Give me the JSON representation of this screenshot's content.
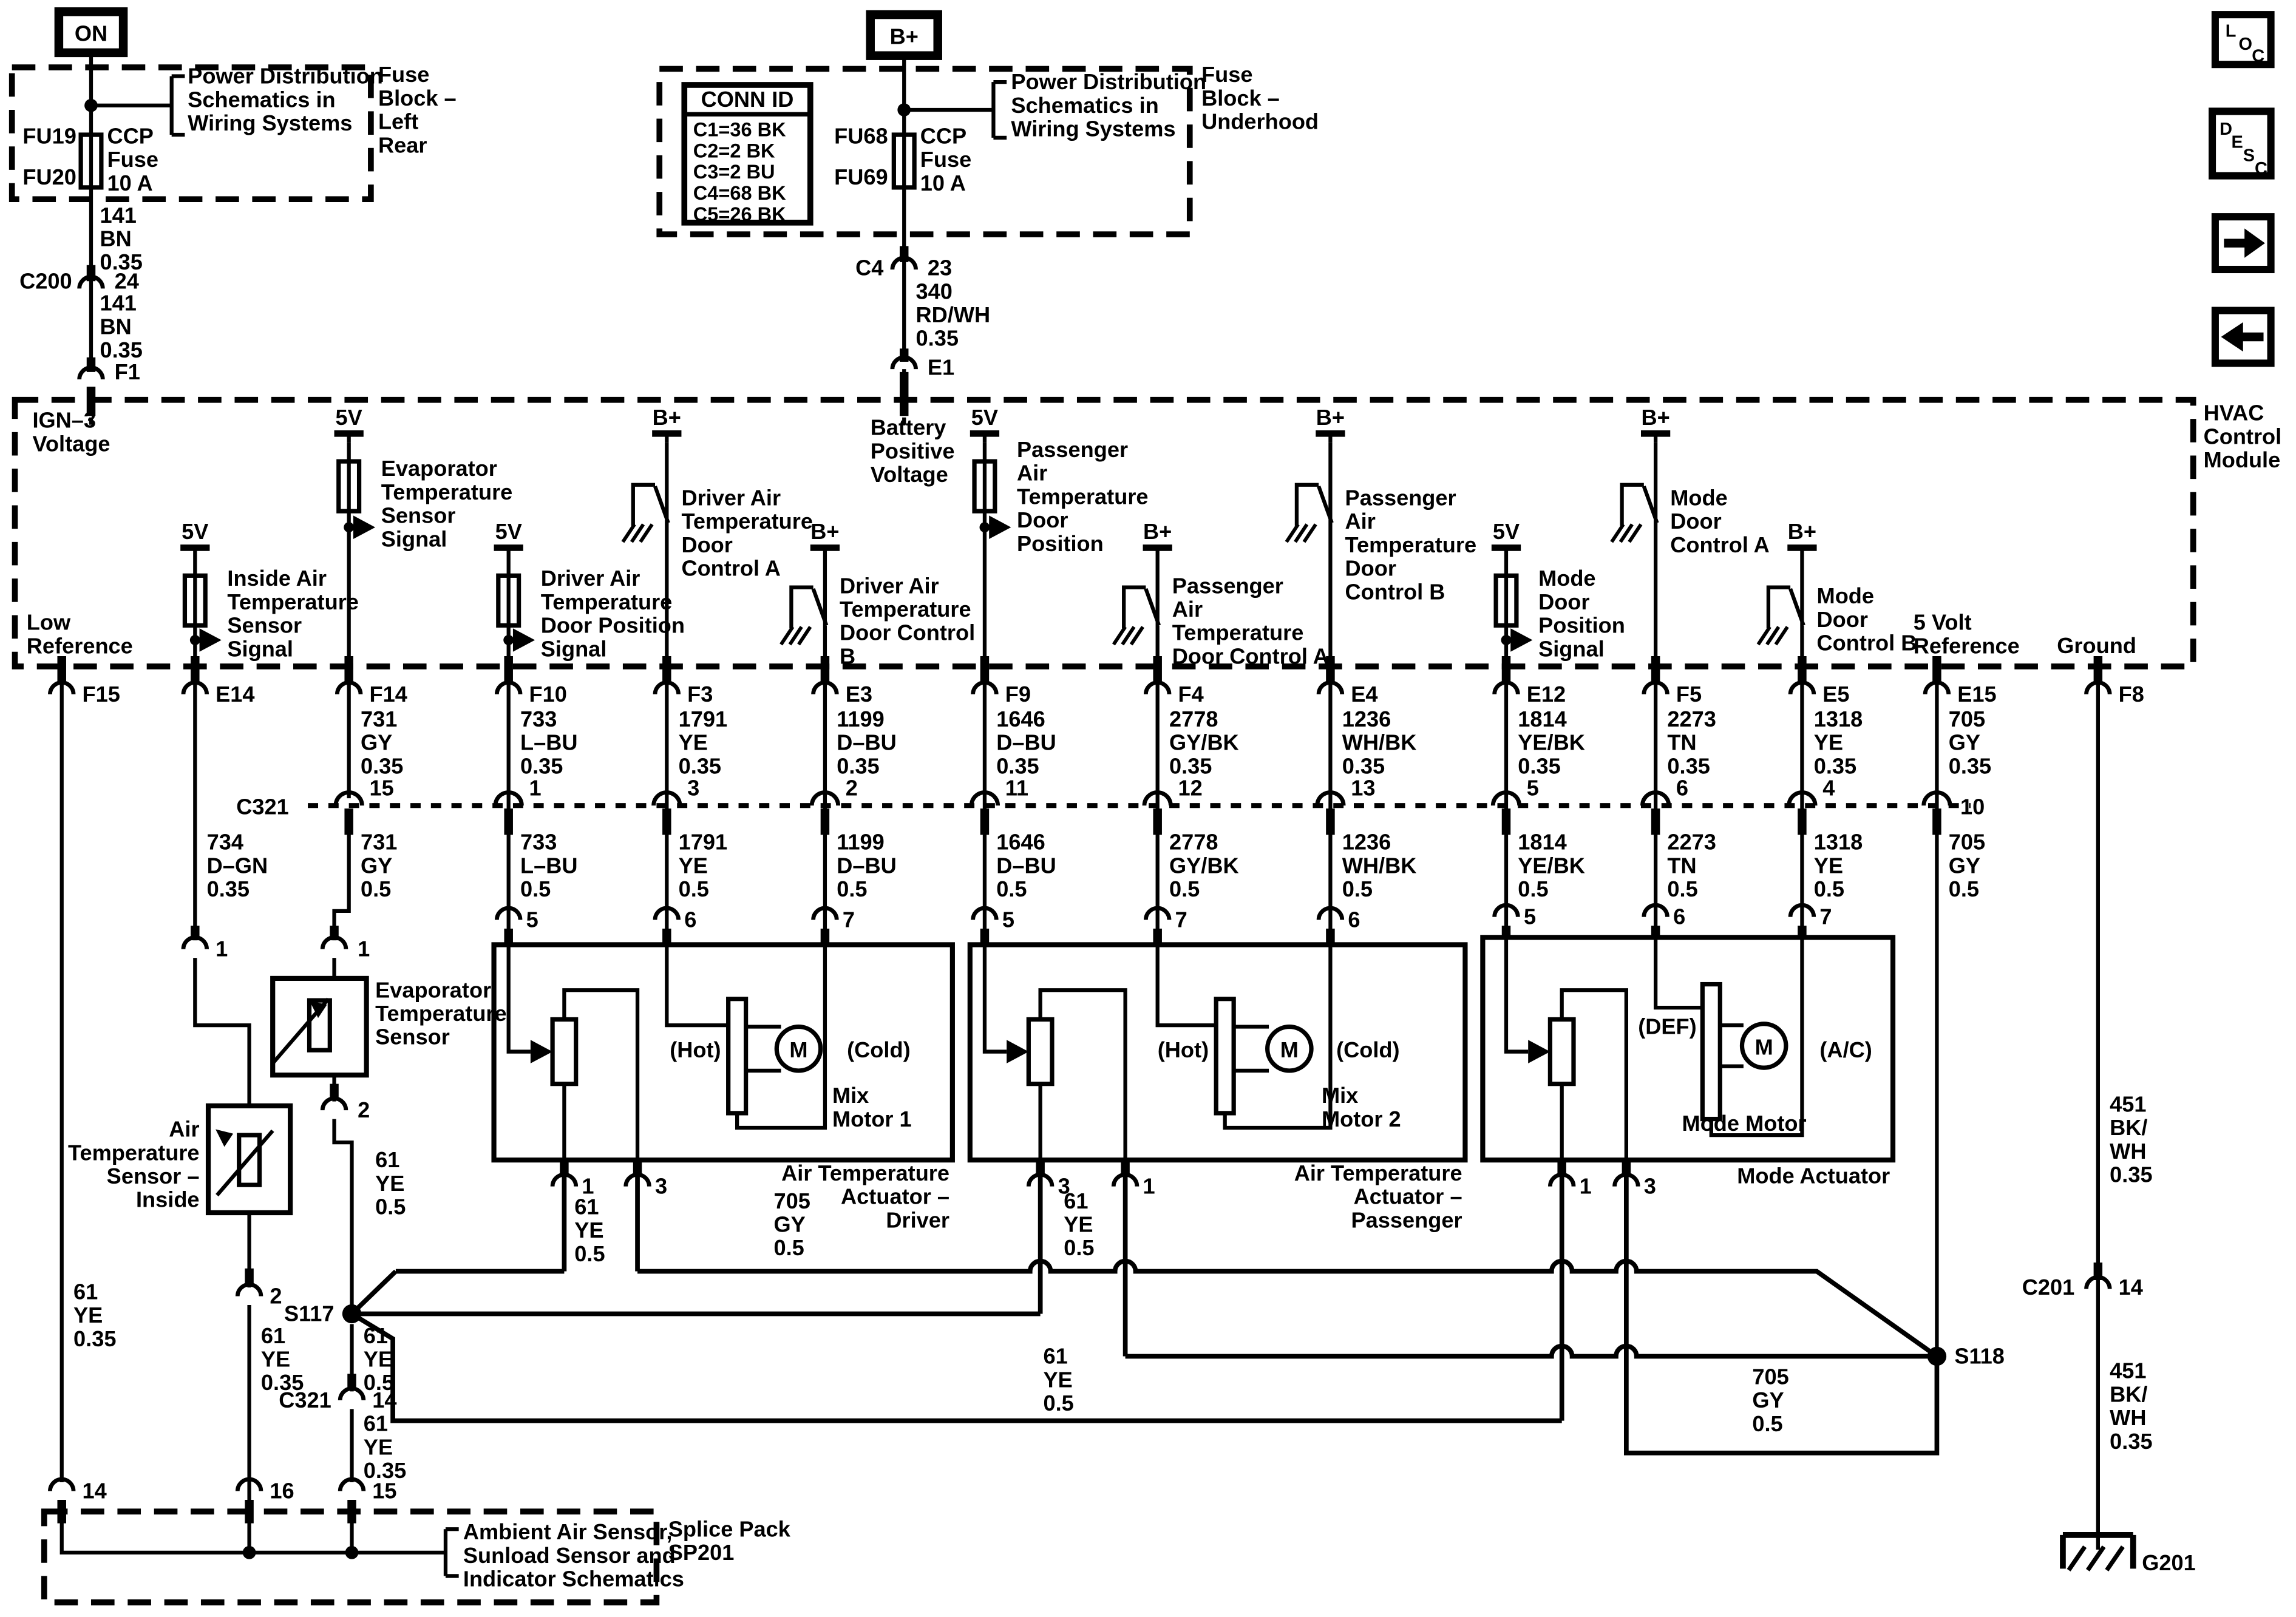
{
  "tl": {
    "on": "ON",
    "pd": [
      "Power Distribution",
      "Schematics in",
      "Wiring Systems"
    ],
    "block": [
      "Fuse",
      "Block –",
      "Left",
      "Rear"
    ],
    "fu_top": "FU19",
    "fu_bot": "FU20",
    "fuse": [
      "CCP",
      "Fuse",
      "10 A"
    ],
    "w1": [
      "141",
      "BN",
      "0.35"
    ],
    "c200": "C200",
    "p24": "24",
    "w2": [
      "141",
      "BN",
      "0.35"
    ],
    "f1": "F1"
  },
  "tm2": {
    "bp": "B+",
    "cid": "CONN ID",
    "rows": [
      "C1=36 BK",
      "C2=2 BK",
      "C3=2 BU",
      "C4=68 BK",
      "C5=26 BK"
    ],
    "fu_top": "FU68",
    "fu_bot": "FU69",
    "fuse": [
      "CCP",
      "Fuse",
      "10 A"
    ],
    "pd": [
      "Power Distribution",
      "Schematics in",
      "Wiring Systems"
    ],
    "block": [
      "Fuse",
      "Block –",
      "Underhood"
    ],
    "c4": "C4",
    "p23": "23",
    "w": [
      "340",
      "RD/WH",
      "0.35"
    ],
    "e1": "E1"
  },
  "nav": {
    "l1": "L",
    "l2": "O",
    "l3": "C",
    "d1": "D",
    "d2": "E",
    "d3": "S",
    "d4": "C"
  },
  "mod": {
    "name": [
      "HVAC",
      "Control",
      "Module"
    ],
    "ign": [
      "IGN–3",
      "Voltage"
    ],
    "low": [
      "Low",
      "Reference"
    ],
    "batt": [
      "Battery",
      "Positive",
      "Voltage"
    ],
    "v5": "5V",
    "bp": "B+",
    "inside": [
      "Inside Air",
      "Temperature",
      "Sensor",
      "Signal"
    ],
    "evap": [
      "Evaporator",
      "Temperature",
      "Sensor",
      "Signal"
    ],
    "dpos": [
      "Driver Air",
      "Temperature",
      "Door Position",
      "Signal"
    ],
    "dca": [
      "Driver Air",
      "Temperature",
      "Door",
      "Control A"
    ],
    "dcb": [
      "Driver Air",
      "Temperature",
      "Door Control",
      "B"
    ],
    "ppos": [
      "Passenger",
      "Air",
      "Temperature",
      "Door",
      "Position"
    ],
    "pca": [
      "Passenger",
      "Air",
      "Temperature",
      "Door Control A"
    ],
    "pcb": [
      "Passenger",
      "Air",
      "Temperature",
      "Door",
      "Control B"
    ],
    "mpos": [
      "Mode",
      "Door",
      "Position",
      "Signal"
    ],
    "mca": [
      "Mode",
      "Door",
      "Control A"
    ],
    "mcb": [
      "Mode",
      "Door",
      "Control B"
    ],
    "vref": [
      "5 Volt",
      "Reference"
    ],
    "gnd": "Ground"
  },
  "pins": {
    "f15": "F15",
    "e14": "E14",
    "f14": "F14",
    "f10": "F10",
    "f3": "F3",
    "e3": "E3",
    "f9": "F9",
    "f4": "F4",
    "e4": "E4",
    "e12": "E12",
    "f5": "F5",
    "e5": "E5",
    "e15": "E15",
    "f8": "F8"
  },
  "wa": {
    "f14": [
      "731",
      "GY",
      "0.35"
    ],
    "f10": [
      "733",
      "L–BU",
      "0.35"
    ],
    "f3": [
      "1791",
      "YE",
      "0.35"
    ],
    "e3": [
      "1199",
      "D–BU",
      "0.35"
    ],
    "f9": [
      "1646",
      "D–BU",
      "0.35"
    ],
    "f4": [
      "2778",
      "GY/BK",
      "0.35"
    ],
    "e4": [
      "1236",
      "WH/BK",
      "0.35"
    ],
    "e12": [
      "1814",
      "YE/BK",
      "0.35"
    ],
    "f5": [
      "2273",
      "TN",
      "0.35"
    ],
    "e5": [
      "1318",
      "YE",
      "0.35"
    ],
    "e15": [
      "705",
      "GY",
      "0.35"
    ]
  },
  "c321": {
    "label": "C321",
    "label14": "C321",
    "p14": "14",
    "p": {
      "f14": "15",
      "f10": "1",
      "f3": "3",
      "e3": "2",
      "f9": "11",
      "f4": "12",
      "e4": "13",
      "e12": "5",
      "f5": "6",
      "e5": "4",
      "e15": "10"
    }
  },
  "wb": {
    "e14": [
      "734",
      "D–GN",
      "0.35"
    ],
    "f14": [
      "731",
      "GY",
      "0.5"
    ],
    "f10": [
      "733",
      "L–BU",
      "0.5"
    ],
    "f3": [
      "1791",
      "YE",
      "0.5"
    ],
    "e3": [
      "1199",
      "D–BU",
      "0.5"
    ],
    "f9": [
      "1646",
      "D–BU",
      "0.5"
    ],
    "f4": [
      "2778",
      "GY/BK",
      "0.5"
    ],
    "e4": [
      "1236",
      "WH/BK",
      "0.5"
    ],
    "e12": [
      "1814",
      "YE/BK",
      "0.5"
    ],
    "f5": [
      "2273",
      "TN",
      "0.5"
    ],
    "e5": [
      "1318",
      "YE",
      "0.5"
    ],
    "e15": [
      "705",
      "GY",
      "0.5"
    ]
  },
  "bp": {
    "d5": "5",
    "d6": "6",
    "d7": "7",
    "p5": "5",
    "p7": "7",
    "p6": "6",
    "m5": "5",
    "m6": "6",
    "m7": "7"
  },
  "act": {
    "d": {
      "hot": "(Hot)",
      "cold": "(Cold)",
      "motor": [
        "Mix",
        "Motor 1"
      ],
      "m": "M",
      "name": [
        "Air Temperature",
        "Actuator –",
        "Driver"
      ],
      "p1": "1",
      "p3": "3"
    },
    "p": {
      "hot": "(Hot)",
      "cold": "(Cold)",
      "motor": [
        "Mix",
        "Motor 2"
      ],
      "m": "M",
      "name": [
        "Air Temperature",
        "Actuator –",
        "Passenger"
      ],
      "p3": "3",
      "p1": "1"
    },
    "m": {
      "def": "(DEF)",
      "ac": "(A/C)",
      "motor": "Mode Motor",
      "m": "M",
      "name": "Mode Actuator",
      "p1": "1",
      "p3": "3"
    }
  },
  "sens": {
    "evap": {
      "name": [
        "Evaporator",
        "Temperature",
        "Sensor"
      ],
      "p1": "1",
      "p2": "2"
    },
    "inside": {
      "name": [
        "Air",
        "Temperature",
        "Sensor –",
        "Inside"
      ],
      "p1": "1",
      "p2": "2"
    }
  },
  "wires": {
    "f15": [
      "61",
      "YE",
      "0.35"
    ],
    "insideDown": [
      "61",
      "YE",
      "0.35"
    ],
    "evapDown": [
      "61",
      "YE",
      "0.5"
    ],
    "s117down": [
      "61",
      "YE",
      "0.5"
    ],
    "s117c321": [
      "61",
      "YE",
      "0.35"
    ],
    "d1": [
      "61",
      "YE",
      "0.5"
    ],
    "d3": [
      "705",
      "GY",
      "0.5"
    ],
    "p3": [
      "61",
      "YE",
      "0.5"
    ],
    "busLong": [
      "61",
      "YE",
      "0.5"
    ],
    "det": [
      "705",
      "GY",
      "0.5"
    ],
    "f8a": [
      "451",
      "BK/",
      "WH",
      "0.35"
    ],
    "f8b": [
      "451",
      "BK/",
      "WH",
      "0.35"
    ]
  },
  "spl": {
    "s117": "S117",
    "s118": "S118"
  },
  "bot": {
    "p14": "14",
    "p16": "16",
    "p15": "15",
    "text": [
      "Ambient Air Sensor,",
      "Sunload Sensor and",
      "Indicator Schematics"
    ],
    "sp": [
      "Splice Pack",
      "SP201"
    ],
    "c201": "C201",
    "c201p": "14",
    "g201": "G201"
  }
}
